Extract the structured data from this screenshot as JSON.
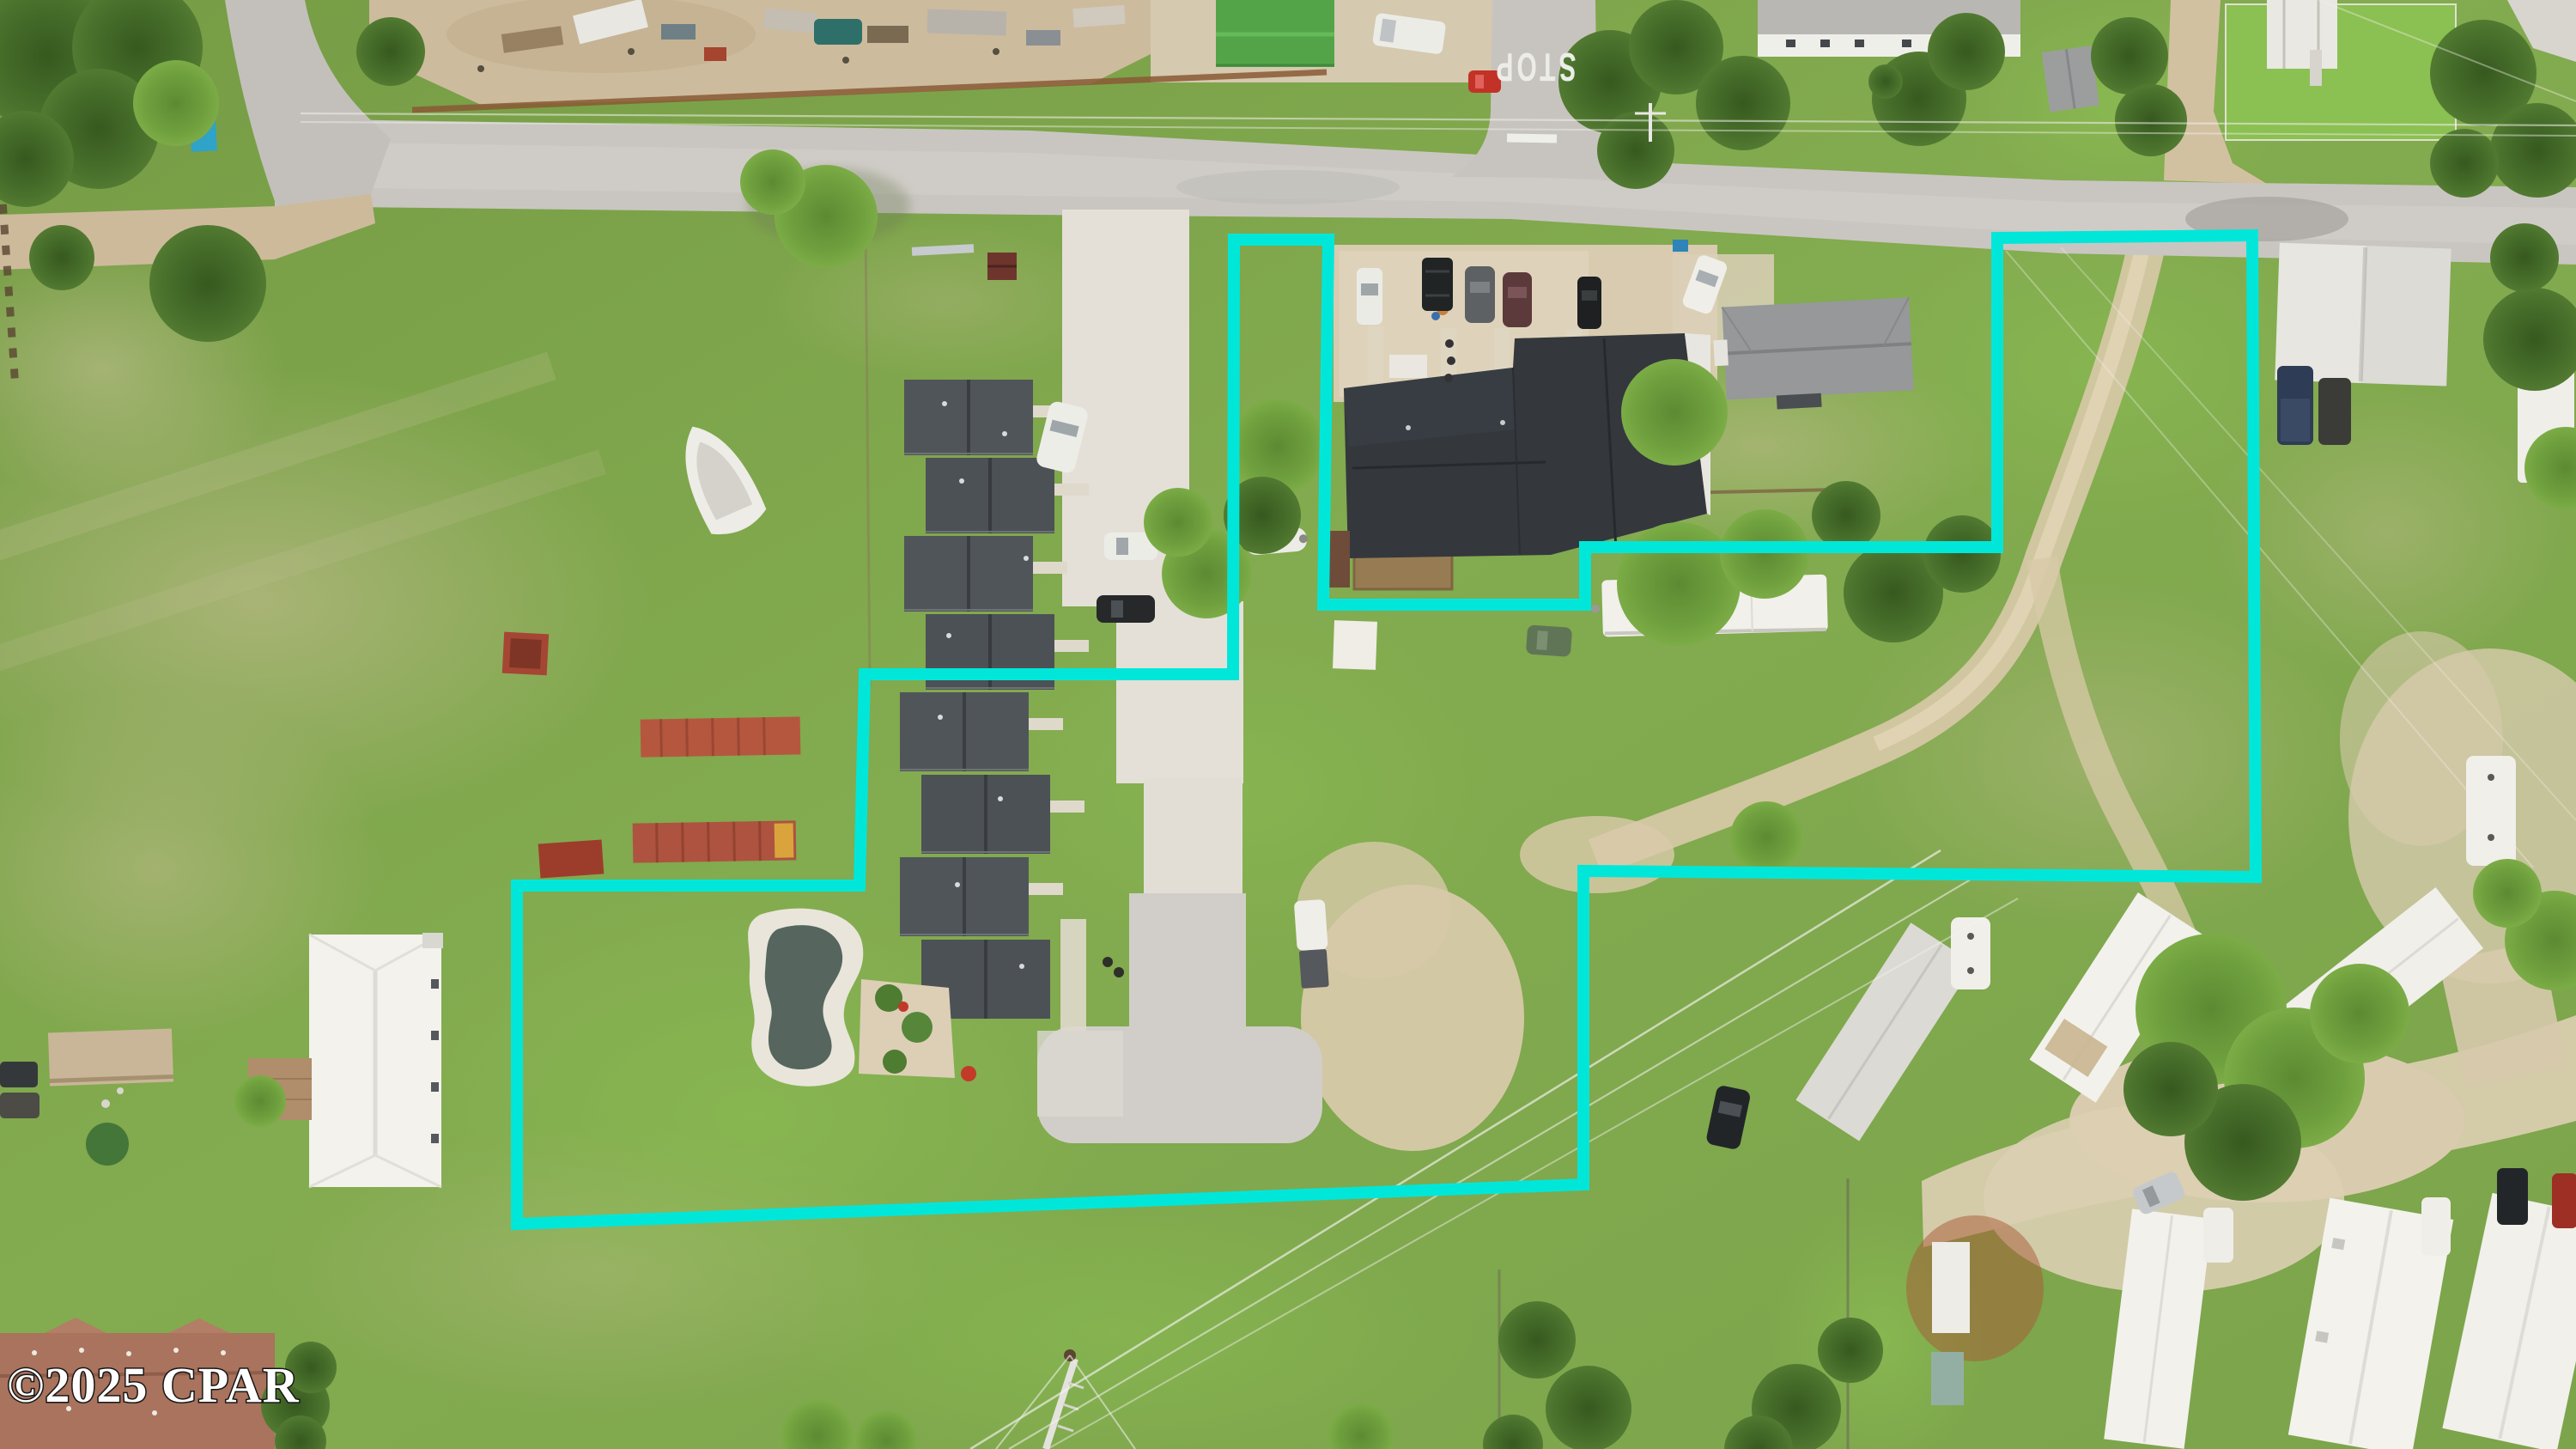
{
  "overlay": {
    "watermark_text": "©2025 CPAR",
    "stop_marking_text": "STOP",
    "boundary_color": "#00E7DA",
    "boundary_stroke_width": "14",
    "boundary_points": "1437,279 1547,279 1541,704 1846,704 1846,637 2326,637 2326,277 2623,274 2627,1021 1844,1014 1844,1379 602,1425 602,1031 1001,1031 1007,785 1436,785"
  },
  "palette": {
    "boundary_cyan": "#00E7DA",
    "grass": "#81A74D",
    "road_asphalt": "#C9C6C1",
    "dirt_sand": "#D5C6A7",
    "concrete": "#E4E0D8",
    "dark_house_roof": "#34383D",
    "townhouse_roof": "#50555A",
    "white_trailer_roof": "#F2F1EC",
    "container_red": "#B5573F",
    "pool_water": "#56655D"
  }
}
